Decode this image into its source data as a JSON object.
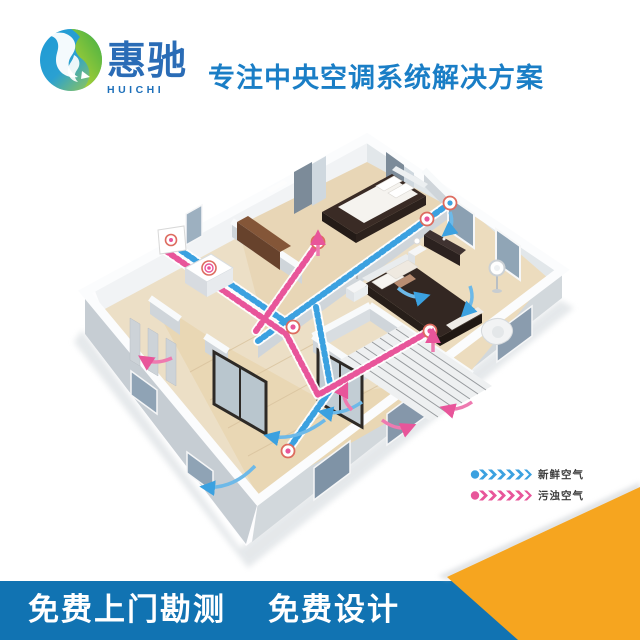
{
  "header": {
    "brand_name_cn": "惠驰",
    "brand_name_en": "HUICHI",
    "tagline": "专注中央空调系统解决方案"
  },
  "diagram": {
    "type": "isometric apartment fresh-air ventilation floor plan",
    "fresh_air_color": "#3ba1e0",
    "exhaust_air_color": "#e8559a"
  },
  "legend": {
    "items": [
      {
        "id": "fresh-air",
        "label": "新鲜空气",
        "color": "#3ba1e0"
      },
      {
        "id": "exhaust-air",
        "label": "污浊空气",
        "color": "#e8559a"
      }
    ]
  },
  "footer": {
    "services": [
      "免费上门勘测",
      "免费设计"
    ],
    "bar_color": "#1173b2",
    "corner_color": "#f6a51f"
  }
}
